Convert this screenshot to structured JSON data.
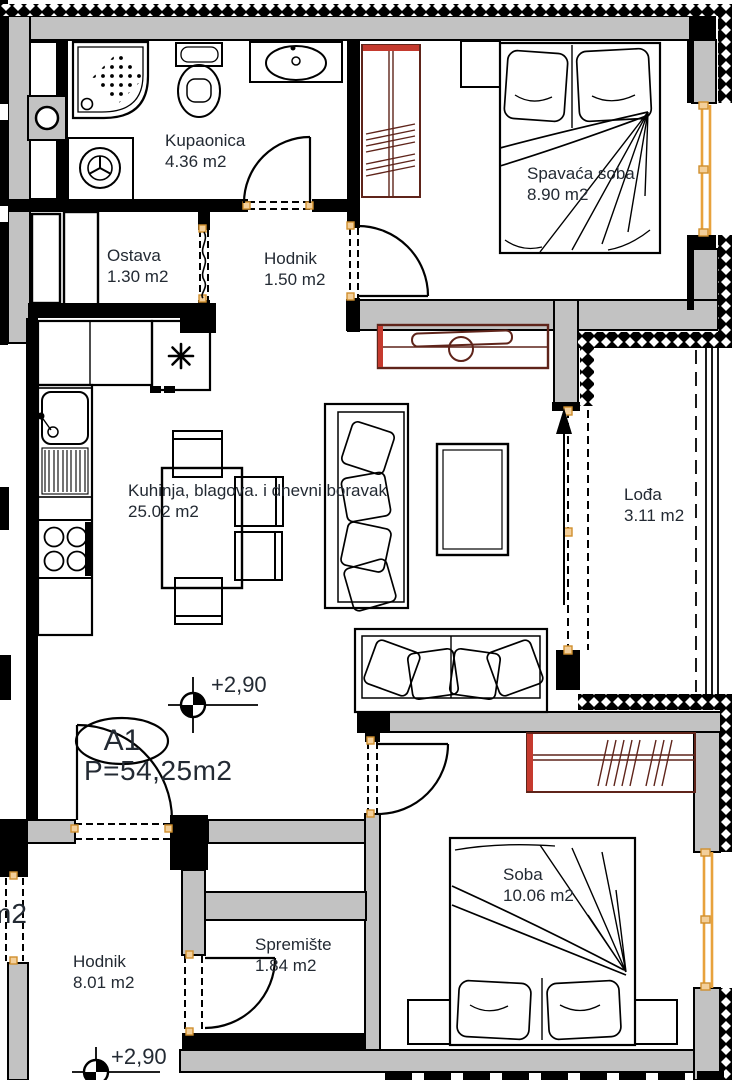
{
  "plan": {
    "unit": {
      "code": "A1",
      "area_label": "P=54,25m2"
    },
    "levels": {
      "upper": "+2,90",
      "lower": "+2,90"
    },
    "neighbor_fragment": "m2",
    "rooms": {
      "kupaonica": {
        "name": "Kupaonica",
        "area": "4.36 m2"
      },
      "spavaca_soba": {
        "name": "Spavaća soba",
        "area": "8.90 m2"
      },
      "ostava": {
        "name": "Ostava",
        "area": "1.30 m2"
      },
      "hodnik_gornji": {
        "name": "Hodnik",
        "area": "1.50 m2"
      },
      "kuhinja": {
        "name": "Kuhinja, blagova. i dnevni boravak",
        "area": "25.02 m2"
      },
      "lodja": {
        "name": "Lođa",
        "area": "3.11 m2"
      },
      "soba": {
        "name": "Soba",
        "area": "10.06 m2"
      },
      "spremiste": {
        "name": "Spremište",
        "area": "1.84 m2"
      },
      "hodnik_donji": {
        "name": "Hodnik",
        "area": "8.01 m2"
      }
    },
    "colors": {
      "wall_fill": "#c2c2c2",
      "line": "#000000",
      "furniture_wood": "#5f241a",
      "accent_red": "#c53a2e",
      "window_orange": "#e8a23c",
      "tick_orange": "#f3cf9a",
      "text": "#232a33"
    }
  }
}
